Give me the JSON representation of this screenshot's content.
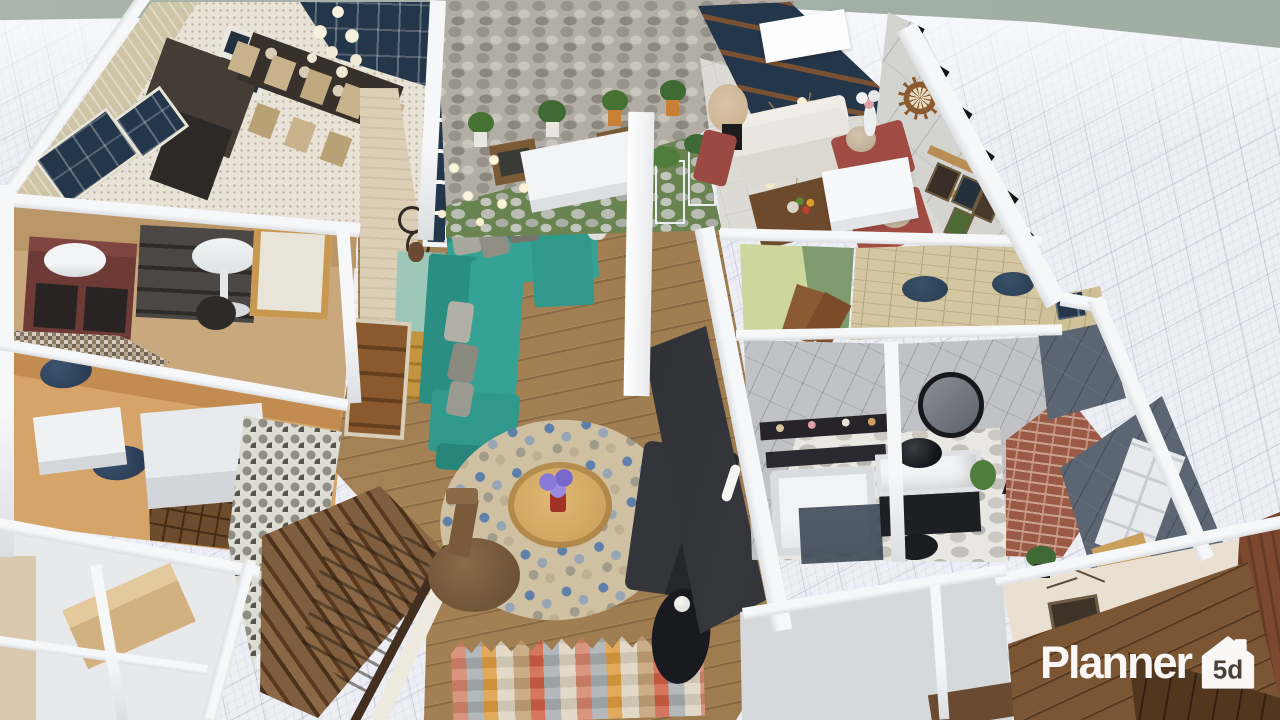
{
  "watermark": {
    "brand": "Planner",
    "badge": "5d"
  },
  "palette": {
    "horizon_band": "#a6b2a9",
    "grid_background": "#edeff5",
    "grid_line": "#6e789b",
    "wall_white": "#f6f7f9",
    "living_room_wood_floor": "#a5804f",
    "sofa_teal": "#2f9a8c",
    "sofa_dark": "#2e2f34",
    "console_teal": "#8fbcae",
    "burgundy_island": "#6d3a36",
    "navy_stool": "#2b3e57",
    "orange_room_floor": "#d6a469",
    "courtyard_green": "#6a8451",
    "stone_wall": "#b2aea5",
    "marble_wall": "#d3d4d0",
    "bathroom_wall": "#c0c2c6",
    "brick_column": "#9a5a45",
    "slate_wall": "#5c6673",
    "stair_wood": "#7e5e3f",
    "red_armchair": "#a04c44",
    "rust_wall": "#7c492f",
    "logo_color": "#ffffff",
    "logo_badge_text": "#4a4038"
  }
}
